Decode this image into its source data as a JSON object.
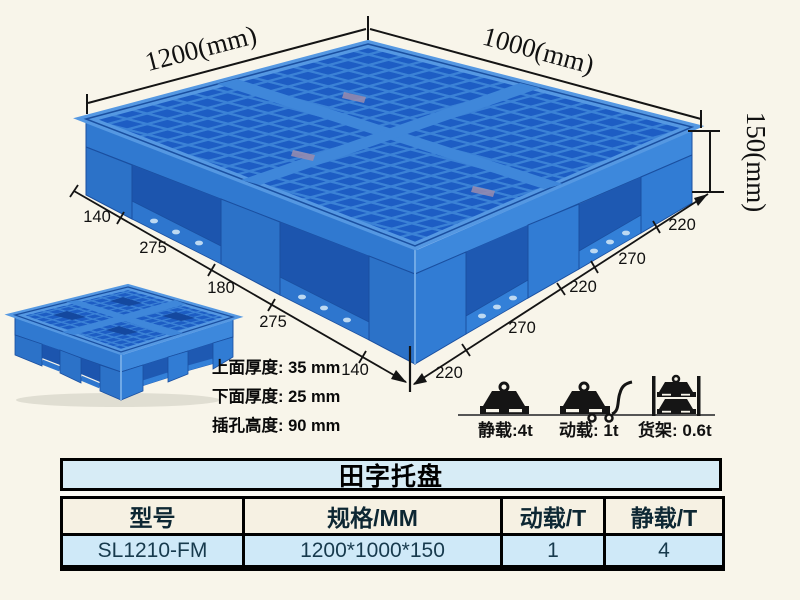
{
  "colors": {
    "page_bg": "#f8f5ea",
    "pallet_main": "#3079d0",
    "pallet_main_right": "#3d88dc",
    "pallet_frame": "#5598e2",
    "pallet_pocket": "#1c55ae",
    "pallet_foot": "#2c72c8",
    "grid_hole": "#1d5dc4",
    "grid_line": "#3b82d6",
    "table_title_bg": "#d7ecf6",
    "table_header_bg": "#f6f1e3",
    "table_data_bg": "#cfe9f8"
  },
  "figure": {
    "dim_width": "1200(mm)",
    "dim_depth": "1000(mm)",
    "dim_height": "150(mm)",
    "left_edge_segments": [
      "140",
      "275",
      "180",
      "275",
      "140"
    ],
    "right_edge_segments": [
      "220",
      "270",
      "220",
      "270",
      "220"
    ],
    "spec_lines": [
      "上面厚度: 35 mm",
      "下面厚度: 25 mm",
      "插孔高度: 90 mm"
    ]
  },
  "load_ratings": {
    "static_label": "静载:4t",
    "dynamic_label": "动载: 1t",
    "rack_label": "货架: 0.6t"
  },
  "table": {
    "title": "田字托盘",
    "columns": [
      "型号",
      "规格/MM",
      "动载/T",
      "静载/T"
    ],
    "rows": [
      {
        "model": "SL1210-FM",
        "spec": "1200*1000*150",
        "dynamic": "1",
        "static": "4"
      }
    ]
  }
}
